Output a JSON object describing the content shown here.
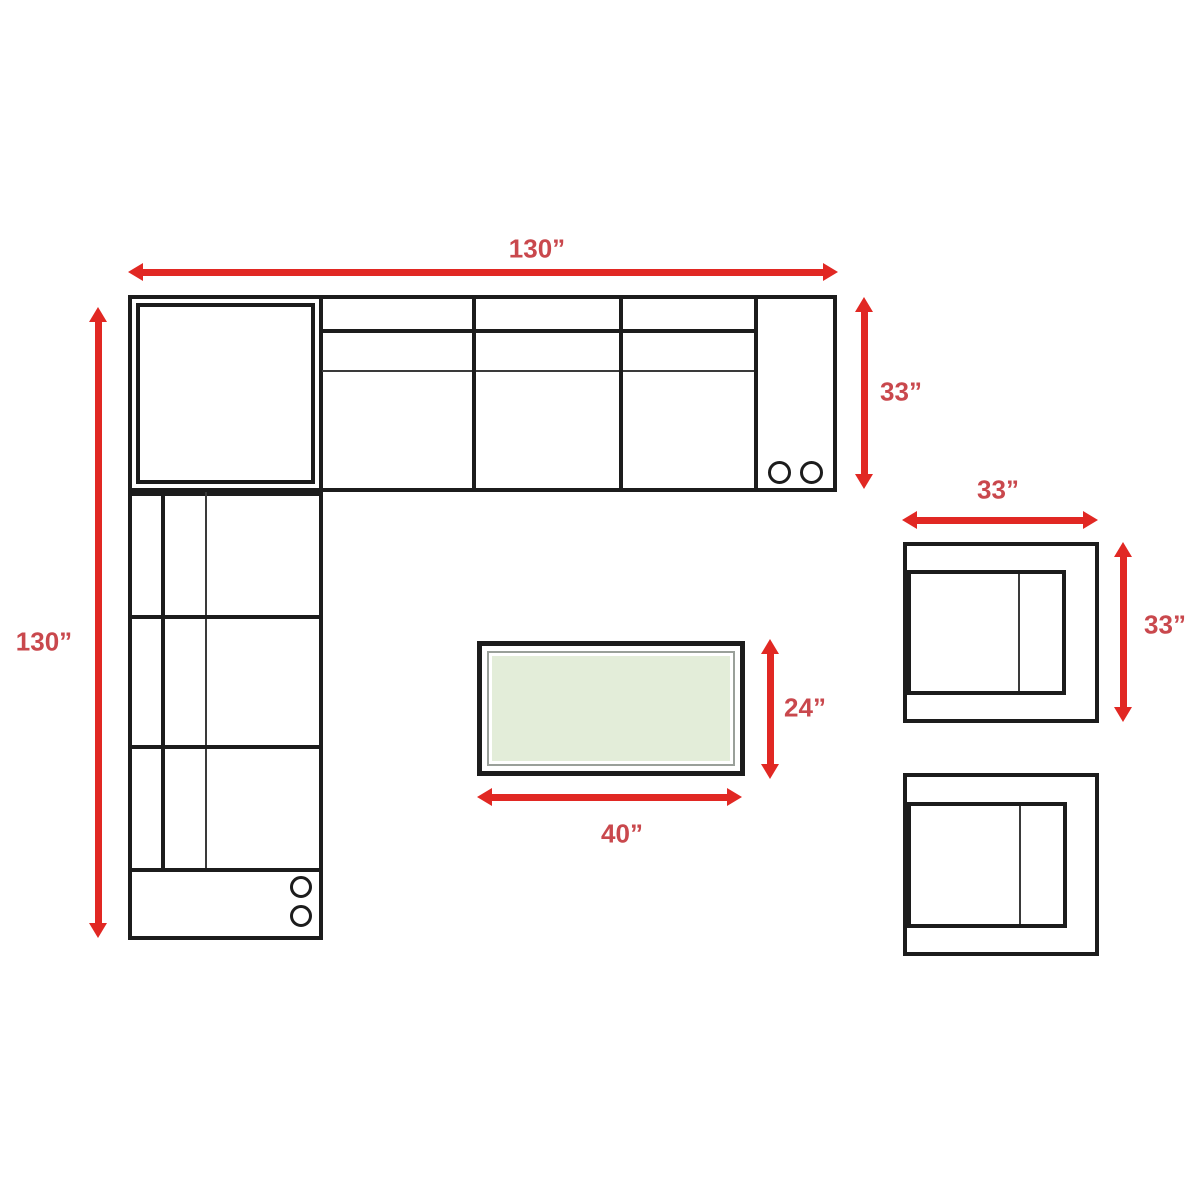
{
  "diagram": {
    "labels": {
      "sectional_width": "130”",
      "sectional_depth": "33”",
      "sectional_length": "130”",
      "armchair_width": "33”",
      "armchair_depth": "33”",
      "table_depth": "24”",
      "table_width": "40”"
    },
    "colors": {
      "arrow": "#e12823",
      "label": "#c9484d",
      "outline": "#1c1c1c",
      "table_fill": "#e3edd9",
      "table_border": "#9aa09a"
    }
  }
}
